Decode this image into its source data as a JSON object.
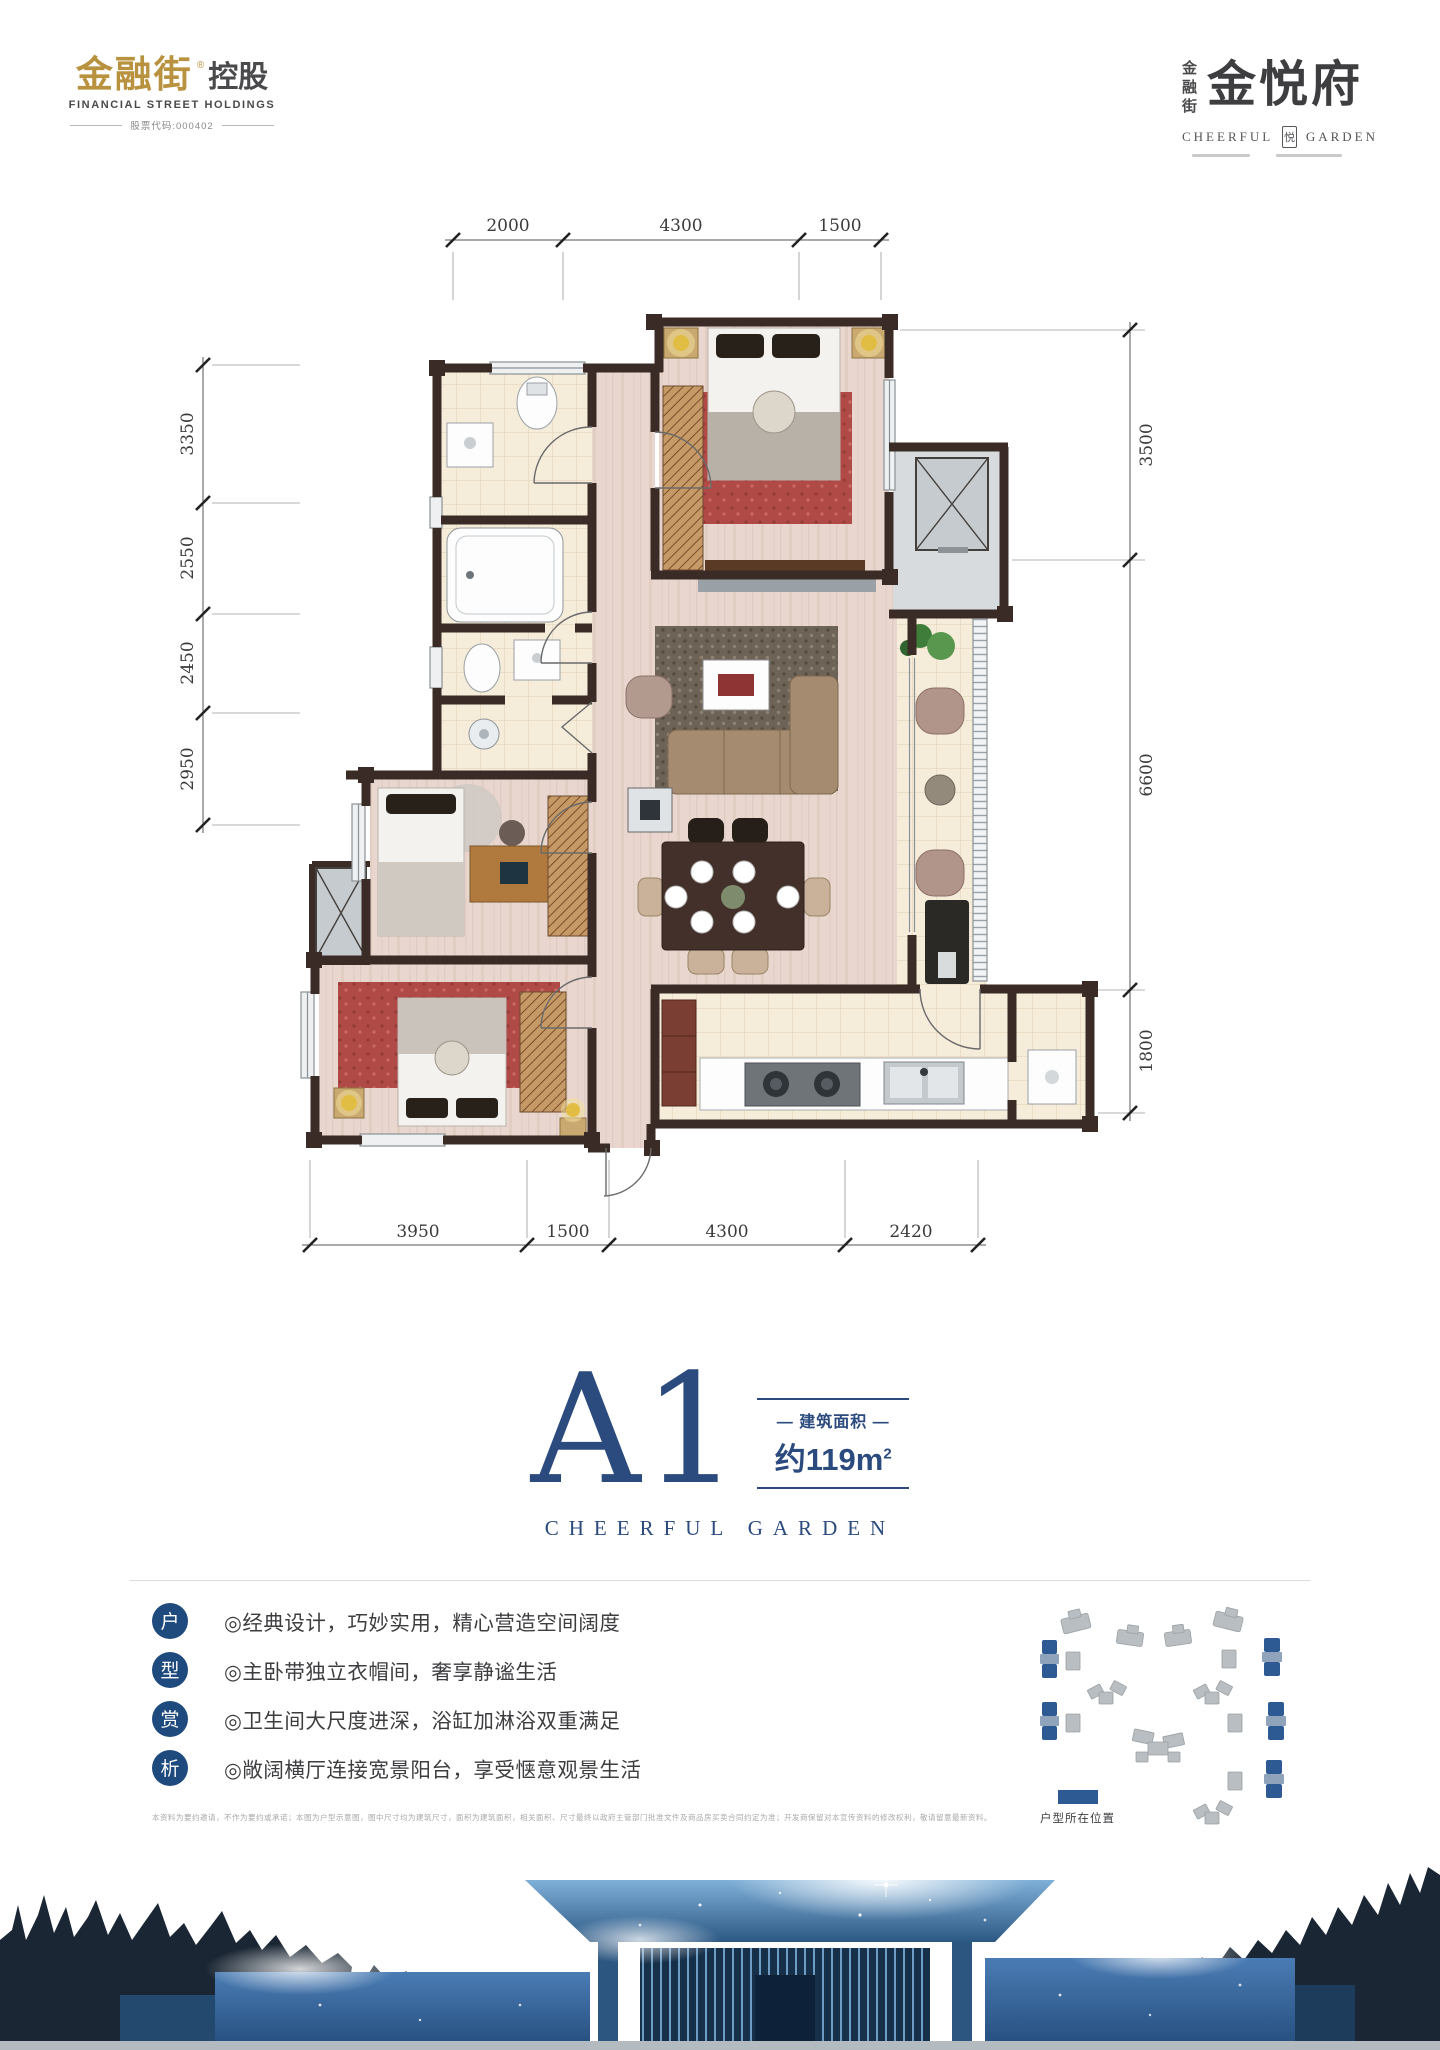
{
  "header": {
    "logo_left": {
      "brand": "金融街",
      "reg": "®",
      "suffix": "控股",
      "subtitle": "FINANCIAL STREET HOLDINGS",
      "stock": "股票代码:000402"
    },
    "logo_right": {
      "vertical": "金融街",
      "brand": "金悦府",
      "en_left": "CHEERFUL",
      "seal": "悦",
      "en_right": "GARDEN"
    }
  },
  "plan": {
    "dims": {
      "top": [
        "2000",
        "4300",
        "1500"
      ],
      "left": [
        "3350",
        "2550",
        "2450",
        "2950"
      ],
      "right": [
        "3500",
        "6600",
        "1800"
      ],
      "bottom": [
        "3950",
        "1500",
        "4300",
        "2420"
      ]
    }
  },
  "unit": {
    "code": "A1",
    "area_label": "— 建筑面积 —",
    "area_value": "约119m",
    "area_sup": "2",
    "subtitle": "CHEERFUL GARDEN"
  },
  "features": {
    "badges": [
      "户",
      "型",
      "赏",
      "析"
    ],
    "items": [
      "◎经典设计，巧妙实用，精心营造空间阔度",
      "◎主卧带独立衣帽间，奢享静谧生活",
      "◎卫生间大尺度进深，浴缸加淋浴双重满足",
      "◎敞阔横厅连接宽景阳台，享受惬意观景生活"
    ]
  },
  "disclaimer": "本资料为要约邀请，不作为要约或承诺；本图为户型示意图，图中尺寸均为建筑尺寸，面积为建筑面积，相关面积、尺寸最终以政府主管部门批准文件及商品房买卖合同约定为准；开发商保留对本宣传资料的修改权利，敬请留意最新资料。",
  "sitemap": {
    "legend": "户型所在位置"
  },
  "colors": {
    "brand_gold": "#b8923f",
    "brand_blue": "#2b4a7d",
    "badge_blue": "#1f4a7e",
    "site_blue": "#2e5a94",
    "wall_brown": "#3a2b26"
  }
}
